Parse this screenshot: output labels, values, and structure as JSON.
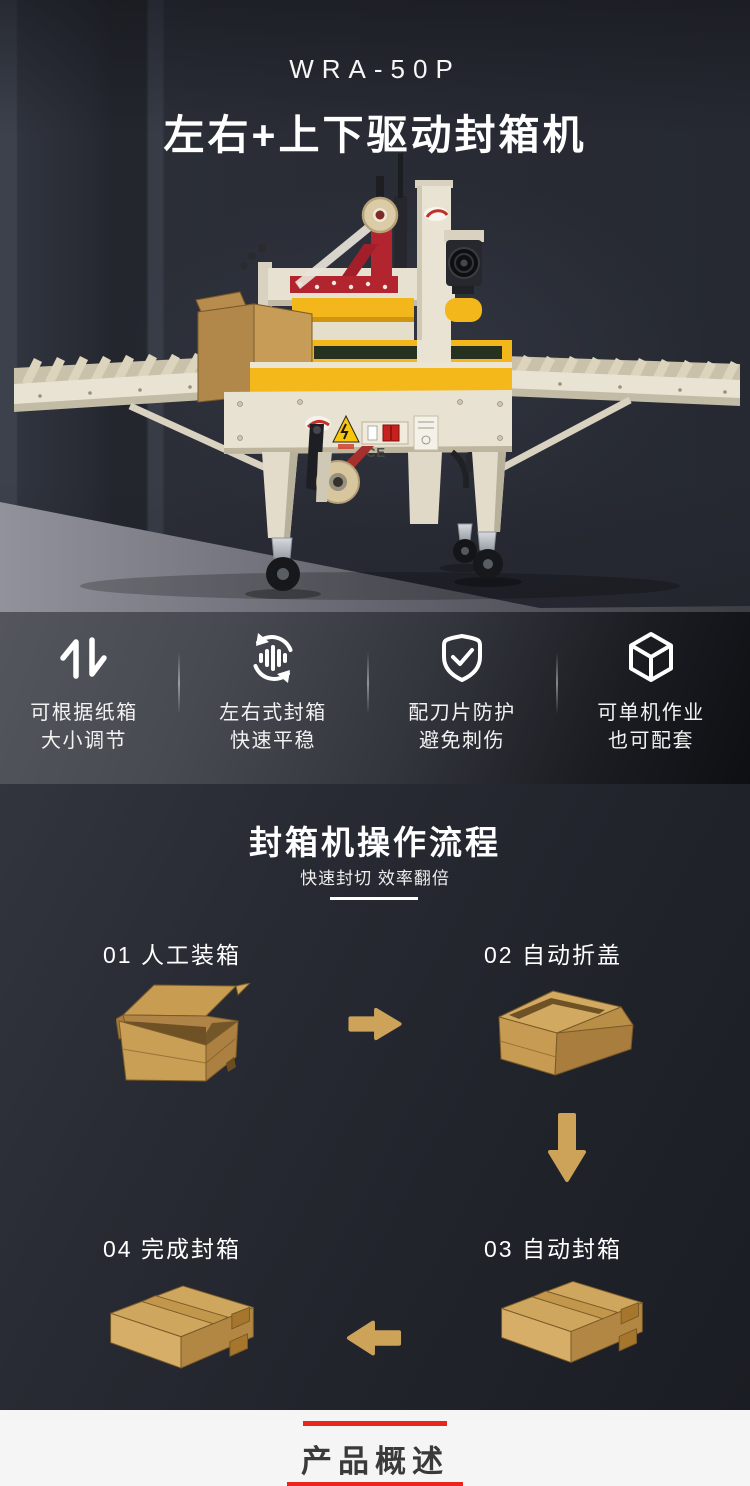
{
  "colors": {
    "bg_dark": "#24262e",
    "panel_light": "#4a4d54",
    "floor_gray": "#8c8c95",
    "light_section_bg": "#f5f5f5",
    "accent_red": "#e8261c",
    "arrow_tan": "#cda35a",
    "box_tan": "#d0a75f",
    "machine_cream": "#e8e2d2",
    "machine_yellow": "#f3b71c",
    "machine_red": "#b2242e",
    "text_light": "#ffffff",
    "text_dark": "#3a3a3a"
  },
  "header": {
    "model": "WRA-50P",
    "title": "左右+上下驱动封箱机"
  },
  "machine": {
    "ce_mark": "CE",
    "description": "left-right and top-bottom drive carton sealing machine with roller conveyors, tape head, carton box"
  },
  "features": [
    {
      "icon": "swap-arrows-icon",
      "line1": "可根据纸箱",
      "line2": "大小调节"
    },
    {
      "icon": "rotate-equalizer-icon",
      "line1": "左右式封箱",
      "line2": "快速平稳"
    },
    {
      "icon": "shield-check-icon",
      "line1": "配刀片防护",
      "line2": "避免刺伤"
    },
    {
      "icon": "cube-icon",
      "line1": "可单机作业",
      "line2": "也可配套"
    }
  ],
  "process": {
    "title": "封箱机操作流程",
    "subtitle": "快速封切 效率翻倍",
    "steps": [
      {
        "label": "01 人工装箱",
        "illustration": "open-carton-icon"
      },
      {
        "label": "02 自动折盖",
        "illustration": "folding-carton-icon"
      },
      {
        "label": "03 自动封箱",
        "illustration": "sealed-carton-icon"
      },
      {
        "label": "04 完成封箱",
        "illustration": "sealed-carton-icon"
      }
    ],
    "arrows": [
      "arrow-right-icon",
      "arrow-down-icon",
      "arrow-left-icon"
    ]
  },
  "footer": {
    "title": "产品概述"
  }
}
